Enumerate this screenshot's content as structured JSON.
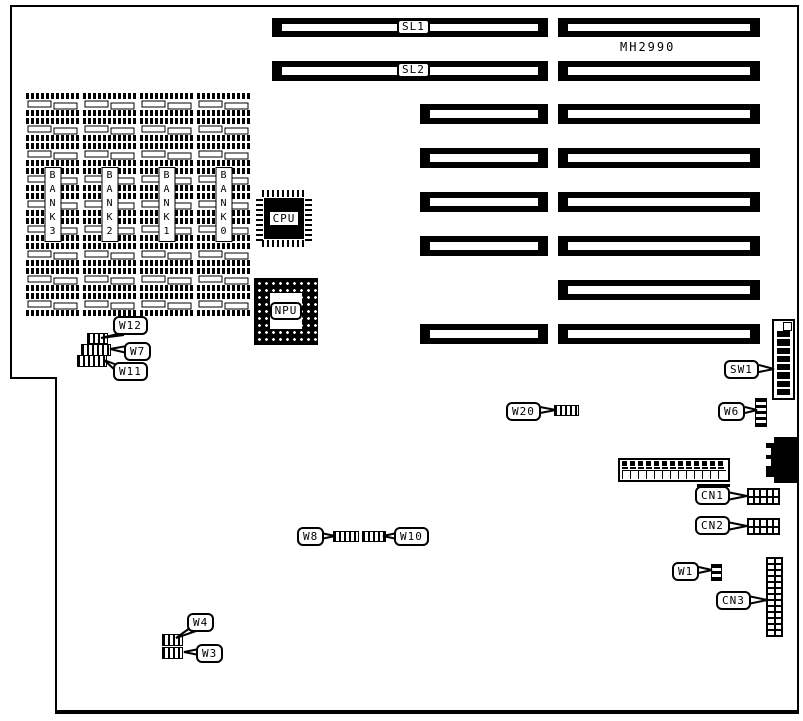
{
  "board": {
    "model_number": "MH2990",
    "memory_banks": [
      "BANK3",
      "BANK2",
      "BANK1",
      "BANK0"
    ],
    "chips": {
      "cpu": "CPU",
      "npu": "NPU"
    },
    "slots": {
      "sl1": "SL1",
      "sl2": "SL2"
    },
    "jumpers": {
      "w1": "W1",
      "w3": "W3",
      "w4": "W4",
      "w6": "W6",
      "w7": "W7",
      "w8": "W8",
      "w10": "W10",
      "w11": "W11",
      "w12": "W12",
      "w20": "W20"
    },
    "switches": {
      "sw1": "SW1"
    },
    "connectors": {
      "cn1": "CN1",
      "cn2": "CN2",
      "cn3": "CN3"
    }
  }
}
